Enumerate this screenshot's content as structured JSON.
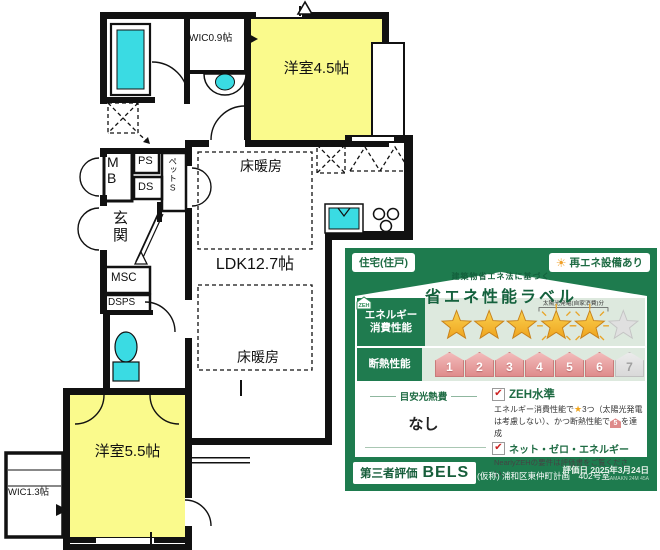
{
  "floor_plan": {
    "labels": {
      "wic09": "WIC0.9帖",
      "room45": "洋室4.5帖",
      "heating_upper": "床暖房",
      "ldk": "LDK12.7帖",
      "heating_lower": "床暖房",
      "mb": "MB",
      "ps": "PS",
      "ds": "DS",
      "pet_storage": "ペットS",
      "genkan": "玄関",
      "msc": "MSC",
      "dsps": "DSPS",
      "room55": "洋室5.5帖",
      "wic13": "WIC1.3帖"
    },
    "colors": {
      "room_fill": "#FAFA8C",
      "fixture_fill": "#3ADBE3",
      "wall": "#111111"
    }
  },
  "energy_label": {
    "unit_type": "住宅(住戸)",
    "renewable": "再エネ設備あり",
    "subtitle": "建築物省エネ法に基づく",
    "title": "省エネ性能ラベル",
    "energy_row": {
      "label_line1": "エネルギー",
      "label_line2": "消費性能",
      "stars_gold": 3,
      "stars_solar": 2,
      "stars_gray": 1,
      "solar_note": "太陽光発電(自家消費)分"
    },
    "insulation_row": {
      "label": "断熱性能",
      "levels": [
        "1",
        "2",
        "3",
        "4",
        "5",
        "6",
        "7"
      ],
      "achieved_max": 6
    },
    "cost": {
      "label": "目安光熱費",
      "value": "なし"
    },
    "zeh": {
      "check1_label": "ZEH水準",
      "desc_a": "エネルギー消費性能で",
      "desc_b": "3つ（太陽光発電",
      "desc_c": "は考慮しない）、かつ断熱性能で",
      "desc_d": "を達成",
      "grade_icon": "5",
      "check2_label": "ネット・ゼロ・エネルギー",
      "zeh_icon": "ZEH",
      "nearly_note": "NearlyZEHの要件は評価書をご覧ください。"
    },
    "footer": {
      "cert_label": "第三者評価",
      "brand": "BELS",
      "property": "(仮称) 浦和区東仲町計画　402号室",
      "date": "評価日 2025年3月24日",
      "code": "SAMAKN 24M 45A"
    },
    "colors": {
      "panel_green": "#1E7B4E",
      "deep_green": "#14613D",
      "row_light": "#DDE9DE",
      "badge_pink": "#E08A8A",
      "star_gold": "#F2B234"
    }
  }
}
